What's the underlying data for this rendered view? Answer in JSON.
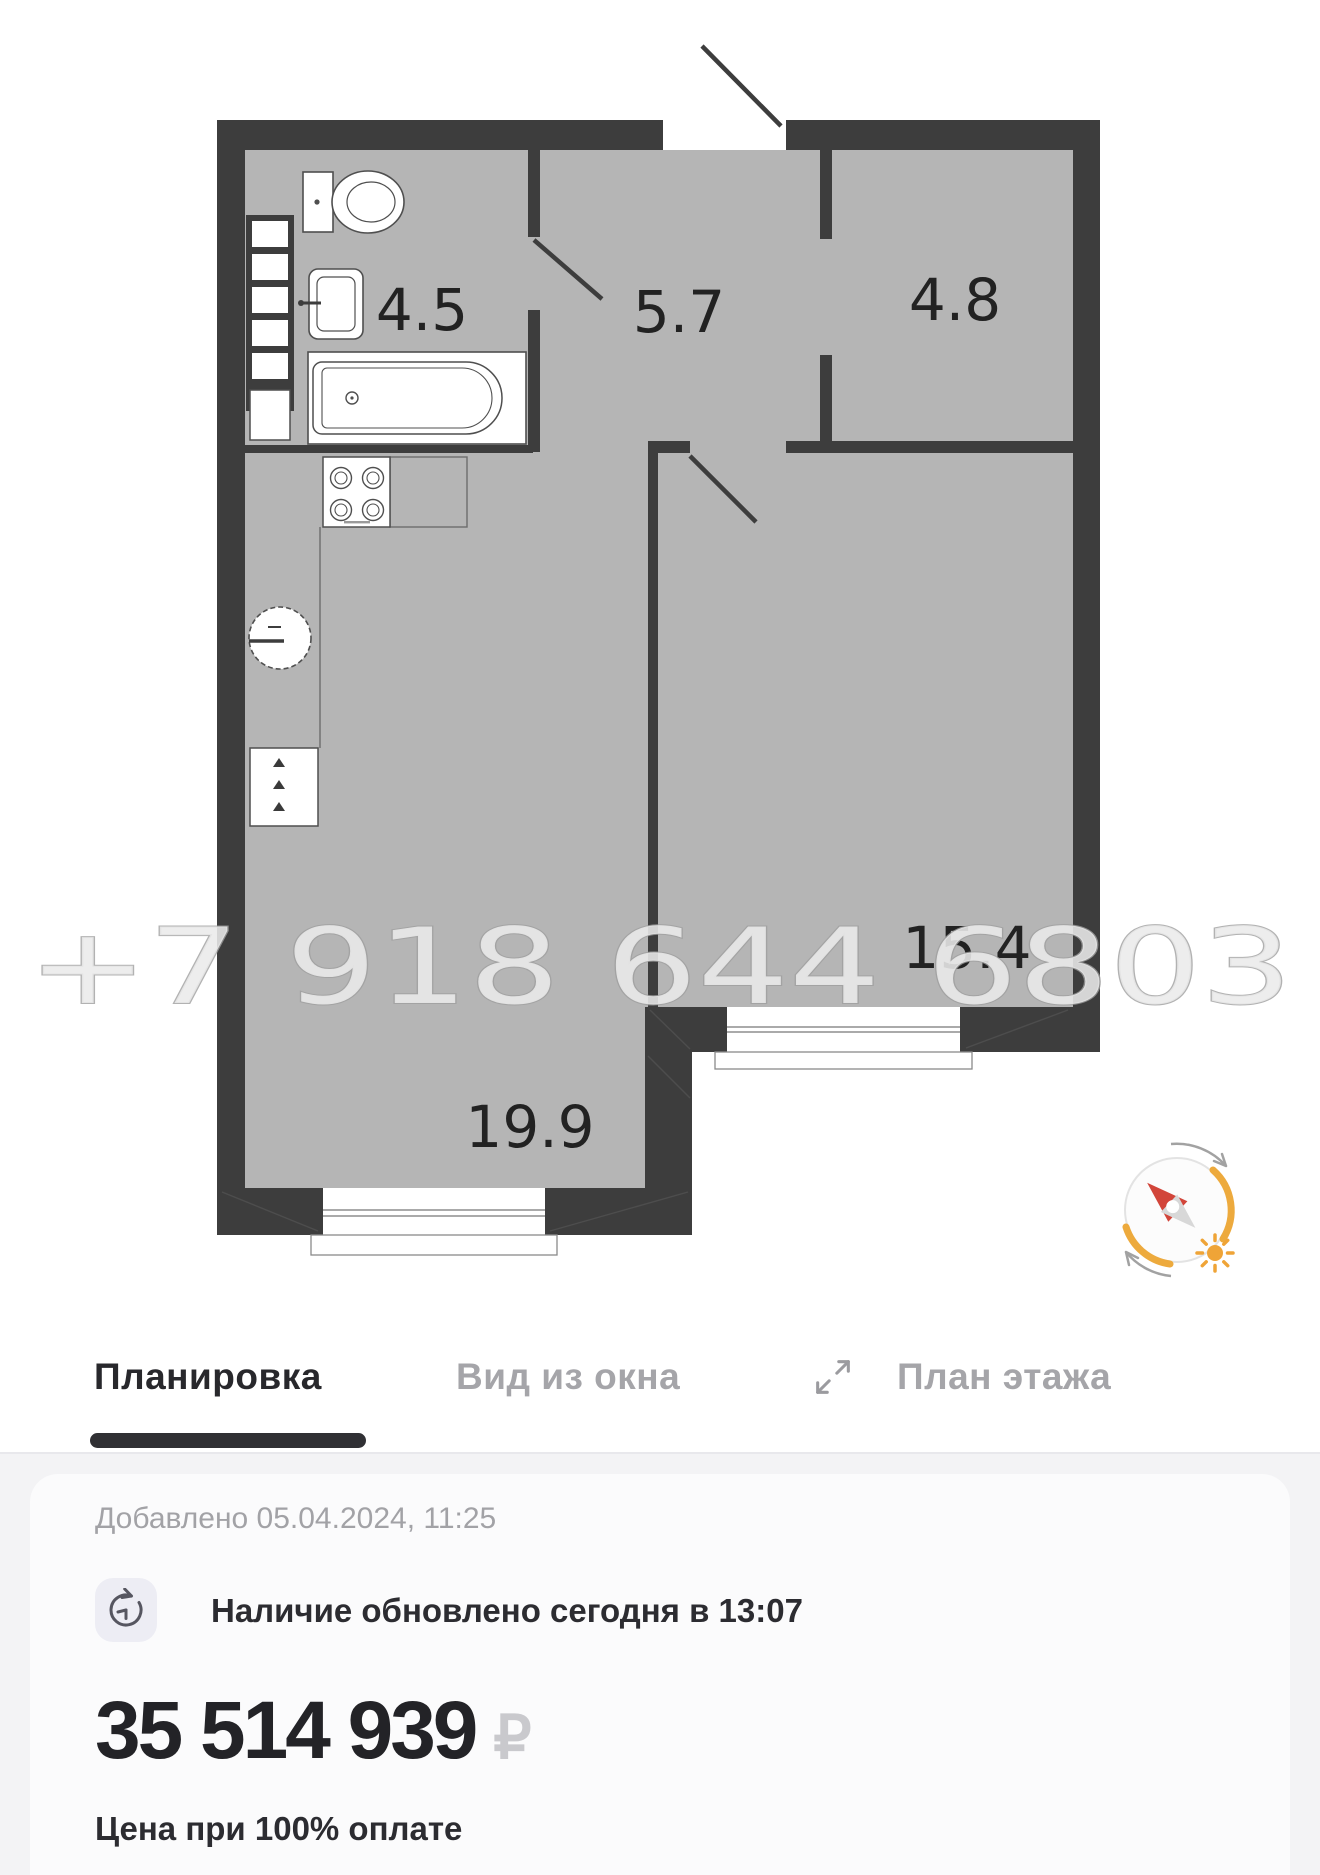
{
  "floor_plan": {
    "watermark": "+7 918 644 6803",
    "rooms": [
      {
        "id": "bathroom",
        "area": "4.5"
      },
      {
        "id": "hallway",
        "area": "5.7"
      },
      {
        "id": "wardrobe",
        "area": "4.8"
      },
      {
        "id": "bedroom",
        "area": "15.4"
      },
      {
        "id": "kitchen-living",
        "area": "19.9"
      }
    ],
    "colors": {
      "wall": "#3d3d3d",
      "floor": "#b5b5b5",
      "compass_orange": "#edaa3d",
      "compass_red": "#d2453a"
    }
  },
  "tabs": {
    "items": [
      {
        "label": "Планировка",
        "active": true
      },
      {
        "label": "Вид из окна",
        "active": false
      },
      {
        "label": "План этажа",
        "active": false
      }
    ]
  },
  "details": {
    "added": "Добавлено 05.04.2024, 11:25",
    "availability": "Наличие обновлено сегодня в 13:07",
    "price": "35 514 939",
    "currency": "₽",
    "price_caption": "Цена при 100% оплате"
  }
}
